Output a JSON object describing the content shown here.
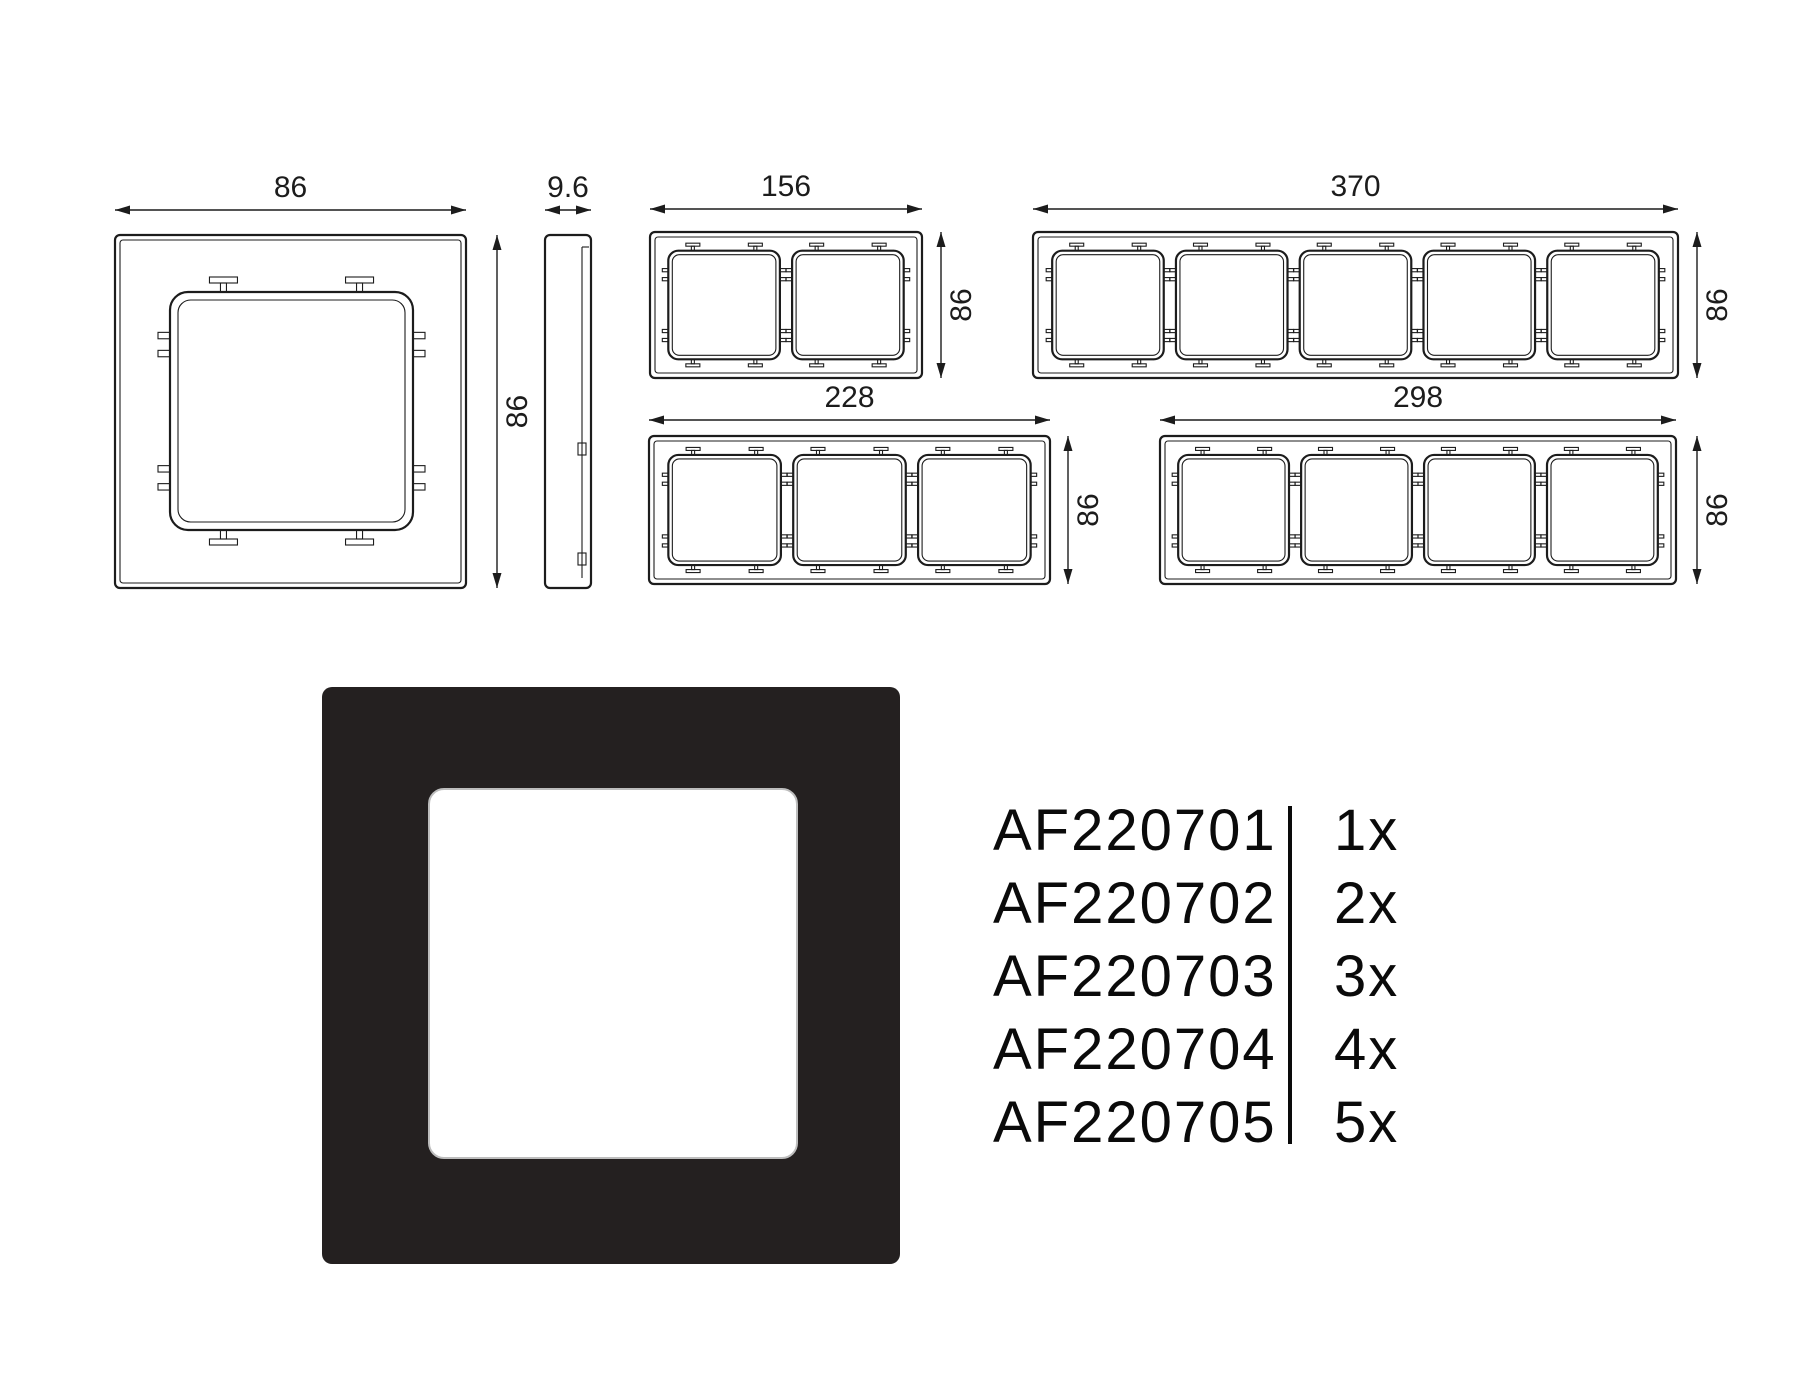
{
  "drawings": {
    "stroke_color": "#1c1c1c",
    "frames": [
      {
        "id": "1gang-front-view",
        "gangs": 1,
        "width_label": "86",
        "height_label": "86"
      },
      {
        "id": "side-profile-view",
        "gangs": 0,
        "width_label": "9.6"
      },
      {
        "id": "2gang-front-view",
        "gangs": 2,
        "width_label": "156",
        "height_label": "86"
      },
      {
        "id": "5gang-front-view",
        "gangs": 5,
        "width_label": "370",
        "height_label": "86"
      },
      {
        "id": "3gang-front-view",
        "gangs": 3,
        "width_label": "228",
        "height_label": "86"
      },
      {
        "id": "4gang-front-view",
        "gangs": 4,
        "width_label": "298",
        "height_label": "86"
      }
    ]
  },
  "product": {
    "frame_color": "#242020",
    "window_color": "#ffffff"
  },
  "table": {
    "rows": [
      {
        "code": "AF220701",
        "qty": "1x"
      },
      {
        "code": "AF220702",
        "qty": "2x"
      },
      {
        "code": "AF220703",
        "qty": "3x"
      },
      {
        "code": "AF220704",
        "qty": "4x"
      },
      {
        "code": "AF220705",
        "qty": "5x"
      }
    ]
  }
}
